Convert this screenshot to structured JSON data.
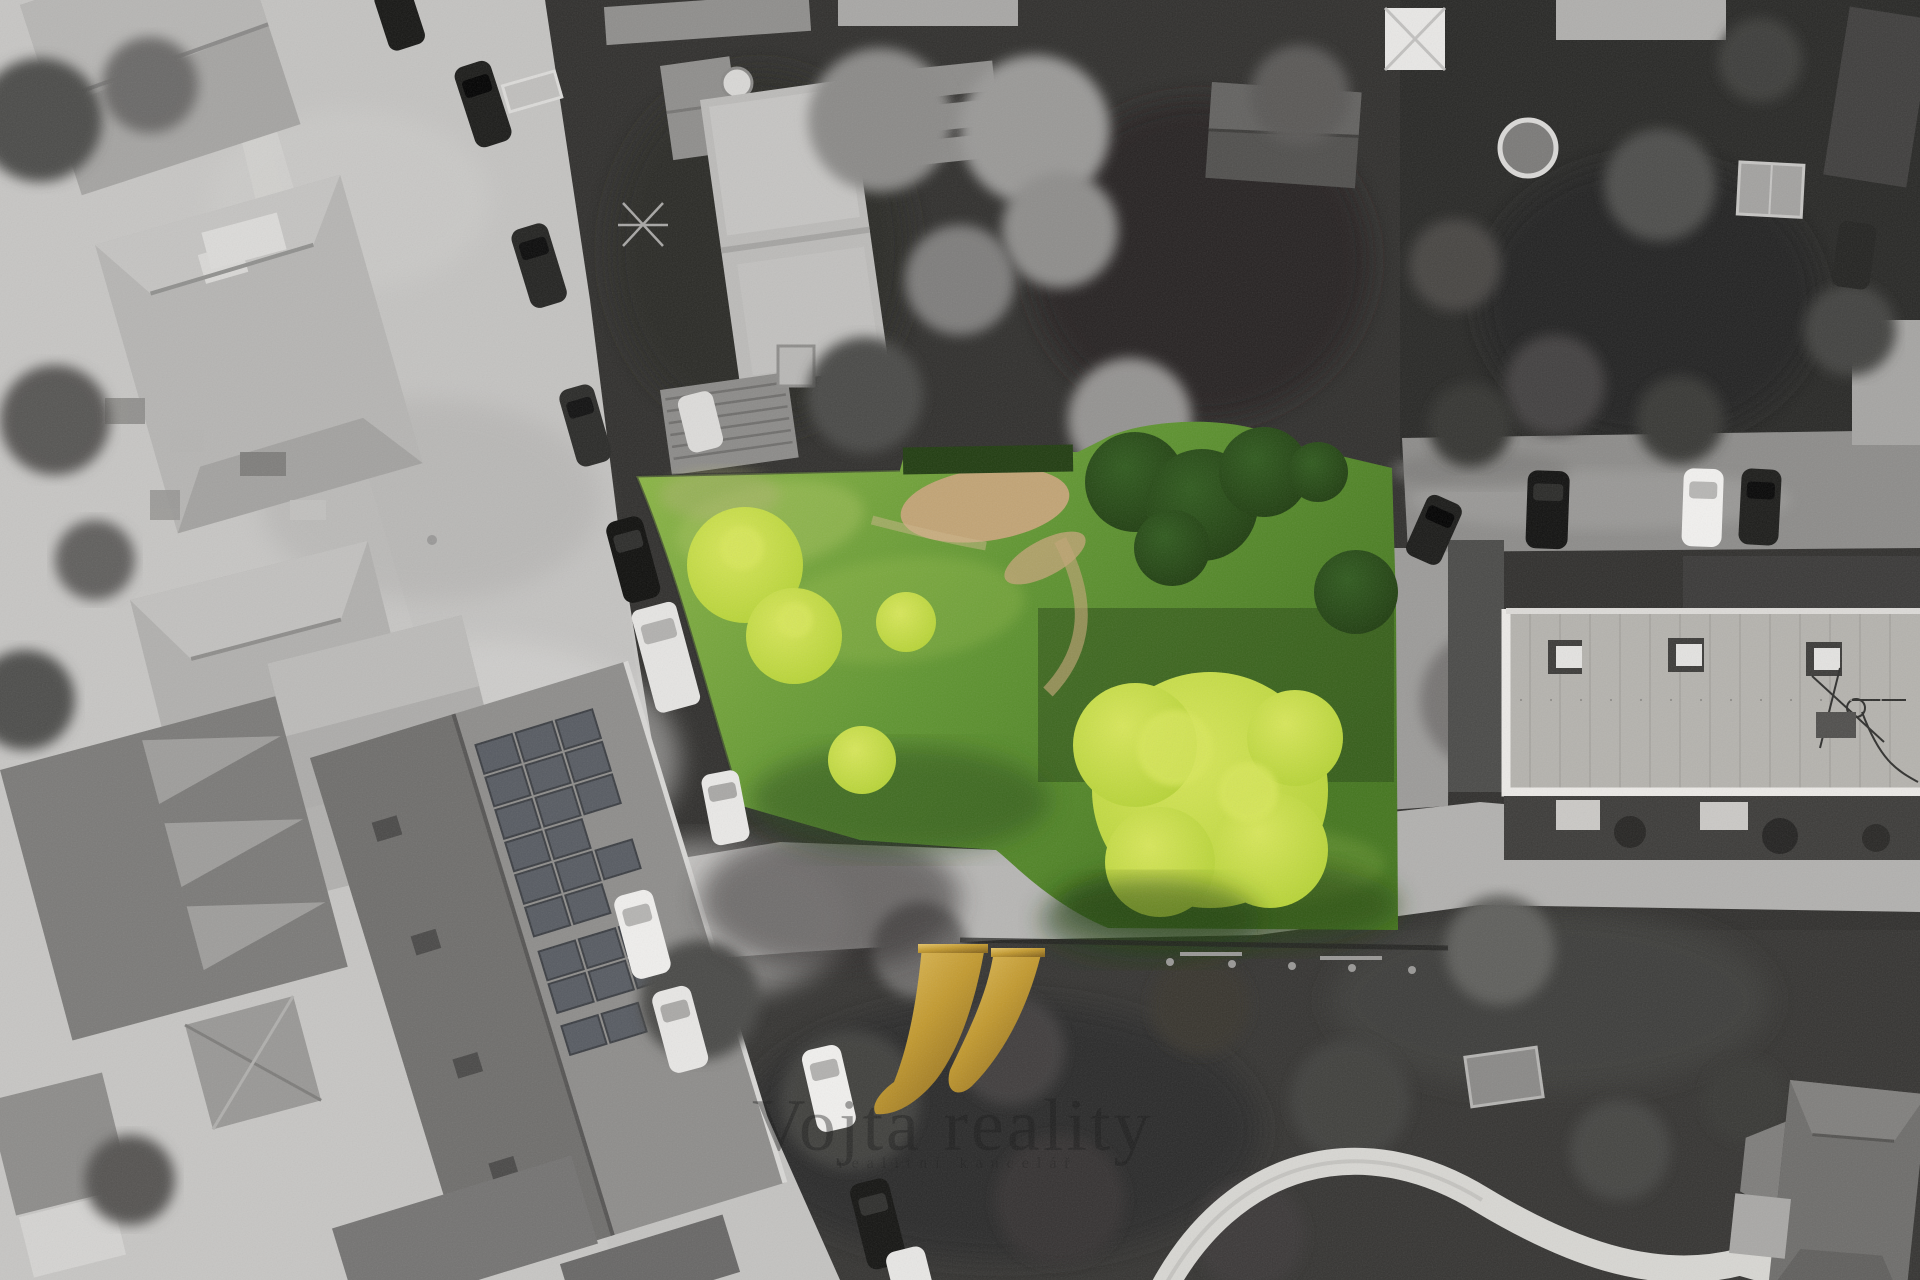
{
  "watermark": {
    "monogram_icon": "vojta-v-monogram",
    "title": "Vojta reality",
    "tagline": "realitní kancelář"
  },
  "colors": {
    "plot_green_light": "#8fb847",
    "plot_green": "#5f9530",
    "plot_green_dark": "#44761e",
    "plot_shadow_green": "#2a4b15",
    "tree_accent_light": "#d8e75a",
    "tree_accent": "#b4d233",
    "tree_dark_green": "#2f5a1d",
    "hedge_green": "#203c10",
    "dirt_tan": "#c2a475",
    "gold_light": "#e6c466",
    "gold": "#c2992e",
    "gold_dark": "#8a671c"
  }
}
